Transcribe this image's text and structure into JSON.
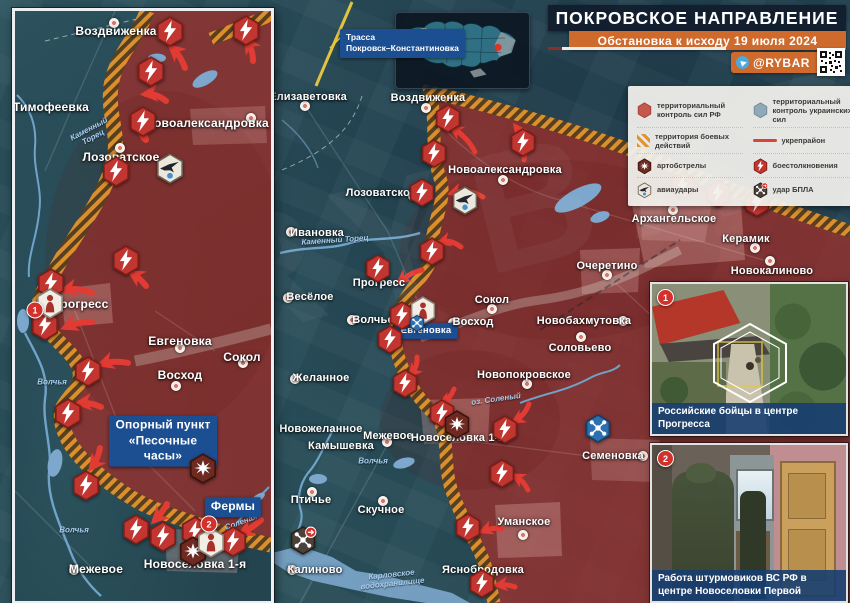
{
  "title": {
    "heading": "ПОКРОВСКОЕ НАПРАВЛЕНИЕ",
    "subtitle": "Обстановка к исходу 19 июля 2024"
  },
  "branding": {
    "channel": "@RYBAR",
    "watermark": "©RYBAR",
    "telegram_icon": "paper-plane-icon",
    "qr_code": "qr-code",
    "accent_orange": "#cf6a2d",
    "title_bar_navy": "#111c2c"
  },
  "colors": {
    "rf_control_fill": "#9b2f2b",
    "combat_zone_hatch": "#e2932d",
    "ua_control_bg": "#24454f",
    "arrow_red": "#e23b33",
    "label_box_blue": "#1c4e92",
    "water_blue": "#6fa3c8"
  },
  "legend": {
    "items": [
      {
        "type": "control-rf",
        "label": "территориальный контроль сил РФ"
      },
      {
        "type": "combat-zone",
        "label": "территория боевых действий"
      },
      {
        "type": "artillery",
        "label": "артобстрелы"
      },
      {
        "type": "aviation",
        "label": "авиаудары"
      },
      {
        "type": "control-ua",
        "label": "территориальный контроль украинских сил"
      },
      {
        "type": "fortline",
        "label": "укрепрайон"
      },
      {
        "type": "clash",
        "label": "боестолкновения"
      },
      {
        "type": "uav",
        "label": "удар БПЛА"
      }
    ]
  },
  "callout": {
    "line1": "Трасса",
    "line2": "Покровск–Константиновка"
  },
  "minimap": {
    "name": "ukraine-overview",
    "marker": "conflict-location"
  },
  "photos": [
    {
      "number": "1",
      "caption": "Российские бойцы в центре Прогресса"
    },
    {
      "number": "2",
      "caption": "Работа штурмовиков ВС РФ в центре Новоселовки Первой"
    }
  ],
  "main_map": {
    "towns": [
      {
        "name": "Елизаветовка",
        "x": 308,
        "y": 97,
        "dot": [
          305,
          106
        ]
      },
      {
        "name": "Воздвиженка",
        "x": 428,
        "y": 98,
        "dot": [
          426,
          108
        ]
      },
      {
        "name": "Новоалександровка",
        "x": 505,
        "y": 170,
        "dot": [
          503,
          180
        ]
      },
      {
        "name": "Лозоватское",
        "x": 381,
        "y": 193,
        "dot": [
          413,
          196
        ]
      },
      {
        "name": "Ивановка",
        "x": 317,
        "y": 233,
        "dot": [
          291,
          232
        ]
      },
      {
        "name": "Прогресс",
        "x": 379,
        "y": 283
      },
      {
        "name": "Весёлое",
        "x": 310,
        "y": 297,
        "dot": [
          288,
          298
        ]
      },
      {
        "name": "Волчье",
        "x": 373,
        "y": 320,
        "dot": [
          352,
          320
        ]
      },
      {
        "name": "Евгеновка",
        "x": 426,
        "y": 331,
        "boxed": true
      },
      {
        "name": "Сокол",
        "x": 492,
        "y": 300,
        "dot": [
          492,
          309
        ]
      },
      {
        "name": "Восход",
        "x": 473,
        "y": 322,
        "dot": [
          453,
          323
        ]
      },
      {
        "name": "Желанное",
        "x": 321,
        "y": 378,
        "dot": [
          295,
          379
        ]
      },
      {
        "name": "Новопокровское",
        "x": 524,
        "y": 375,
        "dot": [
          527,
          384
        ]
      },
      {
        "name": "Новожеланное",
        "x": 321,
        "y": 429
      },
      {
        "name": "Межевое",
        "x": 388,
        "y": 436,
        "dot": [
          387,
          442
        ]
      },
      {
        "name": "Камышевка",
        "x": 341,
        "y": 446
      },
      {
        "name": "Новоселовка 1-я",
        "x": 458,
        "y": 438
      },
      {
        "name": "Архангельское",
        "x": 674,
        "y": 219,
        "dot": [
          673,
          210
        ]
      },
      {
        "name": "Керамик",
        "x": 746,
        "y": 239,
        "dot": [
          755,
          248
        ]
      },
      {
        "name": "Очеретино",
        "x": 607,
        "y": 266,
        "dot": [
          607,
          275
        ]
      },
      {
        "name": "Новокалиново",
        "x": 772,
        "y": 271,
        "dot": [
          770,
          261
        ]
      },
      {
        "name": "Новобахмутовка",
        "x": 584,
        "y": 321,
        "dot": [
          623,
          321
        ]
      },
      {
        "name": "Соловьево",
        "x": 580,
        "y": 348,
        "dot": [
          581,
          337
        ]
      },
      {
        "name": "Семеновка",
        "x": 613,
        "y": 456,
        "dot": [
          643,
          456
        ]
      },
      {
        "name": "Уманское",
        "x": 524,
        "y": 522,
        "dot": [
          523,
          535
        ]
      },
      {
        "name": "Яснобродовка",
        "x": 483,
        "y": 570
      },
      {
        "name": "Птичье",
        "x": 311,
        "y": 500,
        "dot": [
          312,
          492
        ]
      },
      {
        "name": "Скучное",
        "x": 381,
        "y": 510,
        "dot": [
          383,
          501
        ]
      },
      {
        "name": "Калиново",
        "x": 315,
        "y": 570,
        "dot": [
          292,
          570
        ]
      }
    ],
    "water_labels": [
      {
        "text": "Каменный Торец",
        "x": 335,
        "y": 240,
        "rot": -4
      },
      {
        "text": "оз. Соленый",
        "x": 496,
        "y": 399,
        "rot": -8
      },
      {
        "text": "Волчья",
        "x": 373,
        "y": 461,
        "rot": 0
      },
      {
        "text": "Карловское\nводохранилище",
        "x": 392,
        "y": 579,
        "rot": -6
      }
    ],
    "icons": [
      {
        "type": "clash",
        "x": 448,
        "y": 118
      },
      {
        "type": "clash",
        "x": 434,
        "y": 153
      },
      {
        "type": "clash",
        "x": 523,
        "y": 142
      },
      {
        "type": "clash",
        "x": 422,
        "y": 192
      },
      {
        "type": "clash",
        "x": 432,
        "y": 251
      },
      {
        "type": "clash",
        "x": 378,
        "y": 268
      },
      {
        "type": "clash",
        "x": 402,
        "y": 315
      },
      {
        "type": "clash",
        "x": 390,
        "y": 339
      },
      {
        "type": "clash",
        "x": 405,
        "y": 383
      },
      {
        "type": "clash",
        "x": 442,
        "y": 413
      },
      {
        "type": "clash",
        "x": 505,
        "y": 429
      },
      {
        "type": "clash",
        "x": 683,
        "y": 185
      },
      {
        "type": "clash",
        "x": 718,
        "y": 193
      },
      {
        "type": "clash",
        "x": 757,
        "y": 202
      },
      {
        "type": "clash",
        "x": 502,
        "y": 473
      },
      {
        "type": "clash",
        "x": 468,
        "y": 527
      },
      {
        "type": "clash",
        "x": 482,
        "y": 583
      },
      {
        "type": "artillery",
        "x": 457,
        "y": 424
      },
      {
        "type": "aviation",
        "x": 465,
        "y": 200
      },
      {
        "type": "soldier",
        "x": 423,
        "y": 310
      },
      {
        "type": "uav-blue",
        "x": 417,
        "y": 323,
        "size": 16
      },
      {
        "type": "uav",
        "x": 303,
        "y": 540
      },
      {
        "type": "uav-blue",
        "x": 598,
        "y": 428
      }
    ],
    "arrows": [
      "M 475,152 Q 468,138 453,128",
      "M 524,160 Q 527,141 516,127",
      "M 483,197 Q 468,188 452,193",
      "M 461,247 Q 451,239 441,242",
      "M 422,270 Q 412,272 400,281",
      "M 417,357 Q 418,366 411,374",
      "M 454,389 Q 450,399 442,403",
      "M 529,404 Q 525,415 515,421",
      "M 528,490 Q 524,481 515,476",
      "M 502,529 Q 493,527 483,531",
      "M 515,587 Q 507,584 498,585"
    ]
  },
  "inset_map": {
    "towns": [
      {
        "name": "Воздвиженка",
        "x": 101,
        "y": 20,
        "dot": [
          99,
          12
        ]
      },
      {
        "name": "Тимофеевка",
        "x": 36,
        "y": 96
      },
      {
        "name": "Новоалександровка",
        "x": 192,
        "y": 112,
        "dot": [
          236,
          107
        ]
      },
      {
        "name": "Лозоватское",
        "x": 106,
        "y": 146,
        "dot": [
          105,
          137
        ]
      },
      {
        "name": "Прогресс",
        "x": 65,
        "y": 293
      },
      {
        "name": "Евгеновка",
        "x": 165,
        "y": 330,
        "dot": [
          165,
          337
        ]
      },
      {
        "name": "Сокол",
        "x": 227,
        "y": 346,
        "dot": [
          228,
          352
        ]
      },
      {
        "name": "Восход",
        "x": 165,
        "y": 364,
        "dot": [
          161,
          375
        ]
      },
      {
        "name": "Межевое",
        "x": 81,
        "y": 558,
        "dot": [
          59,
          559
        ]
      },
      {
        "name": "Новоселовка 1-я",
        "x": 180,
        "y": 553
      },
      {
        "name": "Фермы",
        "x": 218,
        "y": 496,
        "boxed": true
      },
      {
        "name": "Опорный пункт\n«Песочные часы»",
        "x": 148,
        "y": 430,
        "boxed": true
      }
    ],
    "water_labels": [
      {
        "text": "Каменный\nТорец",
        "x": 76,
        "y": 122,
        "rot": -28
      },
      {
        "text": "Волчья",
        "x": 37,
        "y": 371,
        "rot": 0
      },
      {
        "text": "Волчья",
        "x": 59,
        "y": 519,
        "rot": 0
      },
      {
        "text": "Соленая",
        "x": 226,
        "y": 511,
        "rot": -20
      }
    ],
    "icons": [
      {
        "type": "clash",
        "x": 155,
        "y": 20
      },
      {
        "type": "clash",
        "x": 231,
        "y": 19
      },
      {
        "type": "clash",
        "x": 136,
        "y": 60
      },
      {
        "type": "clash",
        "x": 128,
        "y": 110
      },
      {
        "type": "clash",
        "x": 101,
        "y": 160
      },
      {
        "type": "clash",
        "x": 111,
        "y": 249
      },
      {
        "type": "clash",
        "x": 36,
        "y": 272
      },
      {
        "type": "clash",
        "x": 30,
        "y": 314
      },
      {
        "type": "clash",
        "x": 73,
        "y": 360
      },
      {
        "type": "clash",
        "x": 53,
        "y": 402
      },
      {
        "type": "clash",
        "x": 71,
        "y": 474
      },
      {
        "type": "clash",
        "x": 121,
        "y": 518
      },
      {
        "type": "clash",
        "x": 148,
        "y": 525
      },
      {
        "type": "clash",
        "x": 180,
        "y": 520
      },
      {
        "type": "clash",
        "x": 218,
        "y": 530
      },
      {
        "type": "aviation",
        "x": 155,
        "y": 157
      },
      {
        "type": "artillery",
        "x": 188,
        "y": 457
      },
      {
        "type": "artillery",
        "x": 178,
        "y": 540
      },
      {
        "type": "soldier",
        "x": 35,
        "y": 292
      },
      {
        "type": "soldier",
        "x": 196,
        "y": 531
      }
    ],
    "badges": [
      {
        "num": "1",
        "x": 20,
        "y": 299
      },
      {
        "num": "2",
        "x": 194,
        "y": 513
      }
    ],
    "arrows": [
      "M 170,57 Q 166,45 157,37",
      "M 238,50 Q 238,39 232,30",
      "M 151,90 Q 141,82 131,83",
      "M 131,129 Q 129,121 123,117",
      "M 77,282 Q 63,276 50,279",
      "M 77,311 Q 63,311 51,316",
      "M 131,275 Q 125,267 117,262",
      "M 113,352 Q 99,349 87,353",
      "M 86,396 Q 75,391 65,392",
      "M 85,437 Q 83,448 77,456",
      "M 152,493 Q 147,502 140,509",
      "M 246,509 Q 237,517 227,522"
    ]
  }
}
